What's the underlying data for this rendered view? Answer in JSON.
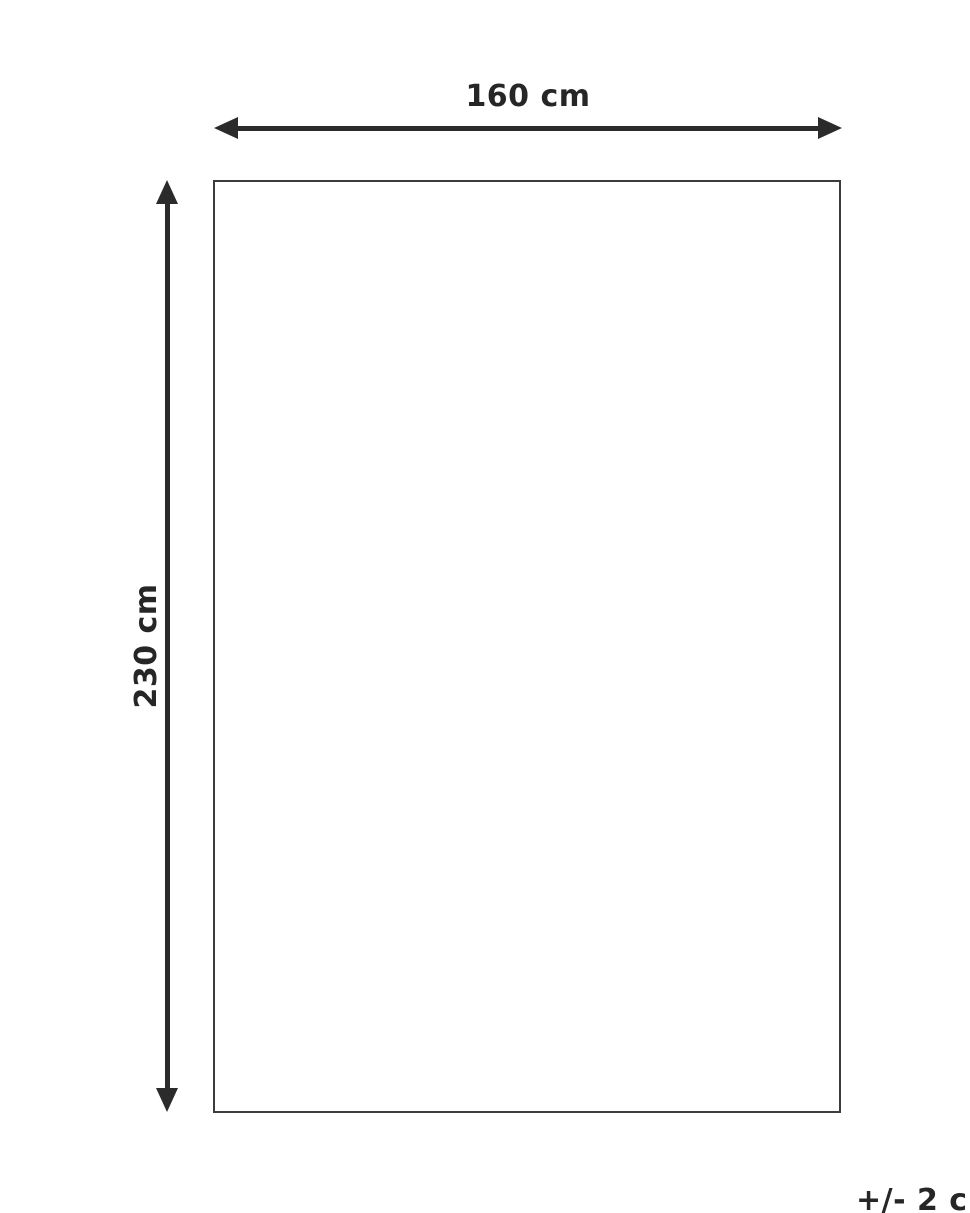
{
  "diagram": {
    "title": "product-dimension-diagram",
    "width_label": "160 cm",
    "height_label": "230 cm",
    "tolerance_label": "+/- 2 cm",
    "colors": {
      "background": "#ffffff",
      "line": "#2b2b2b",
      "rect_border": "#3c3c3c",
      "text": "#262626"
    }
  }
}
